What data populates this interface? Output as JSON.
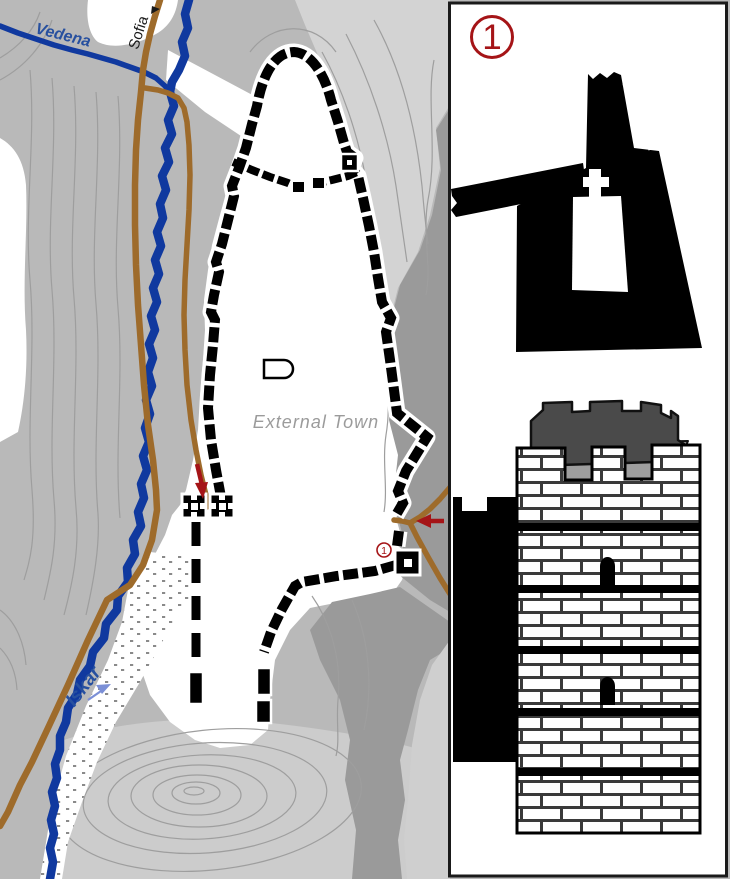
{
  "map": {
    "labels": {
      "river_top": "Vedena",
      "road_destination": "Sofia",
      "river_main": "Iskar",
      "area": "External Town"
    },
    "marker_number": "1"
  },
  "panel": {
    "marker_number": "1"
  },
  "icons": {
    "sofia_direction_arrow": "triangle-right",
    "river_flow_arrow": "arrow-northeast",
    "west_gate_arrow": "arrow-down",
    "east_gate_arrow": "arrow-left"
  },
  "colors": {
    "river": "#10399f",
    "road": "#9e6b2b",
    "wall": "#000000",
    "accent_red": "#a51417",
    "label_blue": "#27509f",
    "label_gray": "#9b9b9b",
    "terrain_base": "#b9b9b9",
    "terrain_light": "#d3d3d3",
    "terrain_dark": "#9a9a9a",
    "contour": "#9e9e9e"
  }
}
